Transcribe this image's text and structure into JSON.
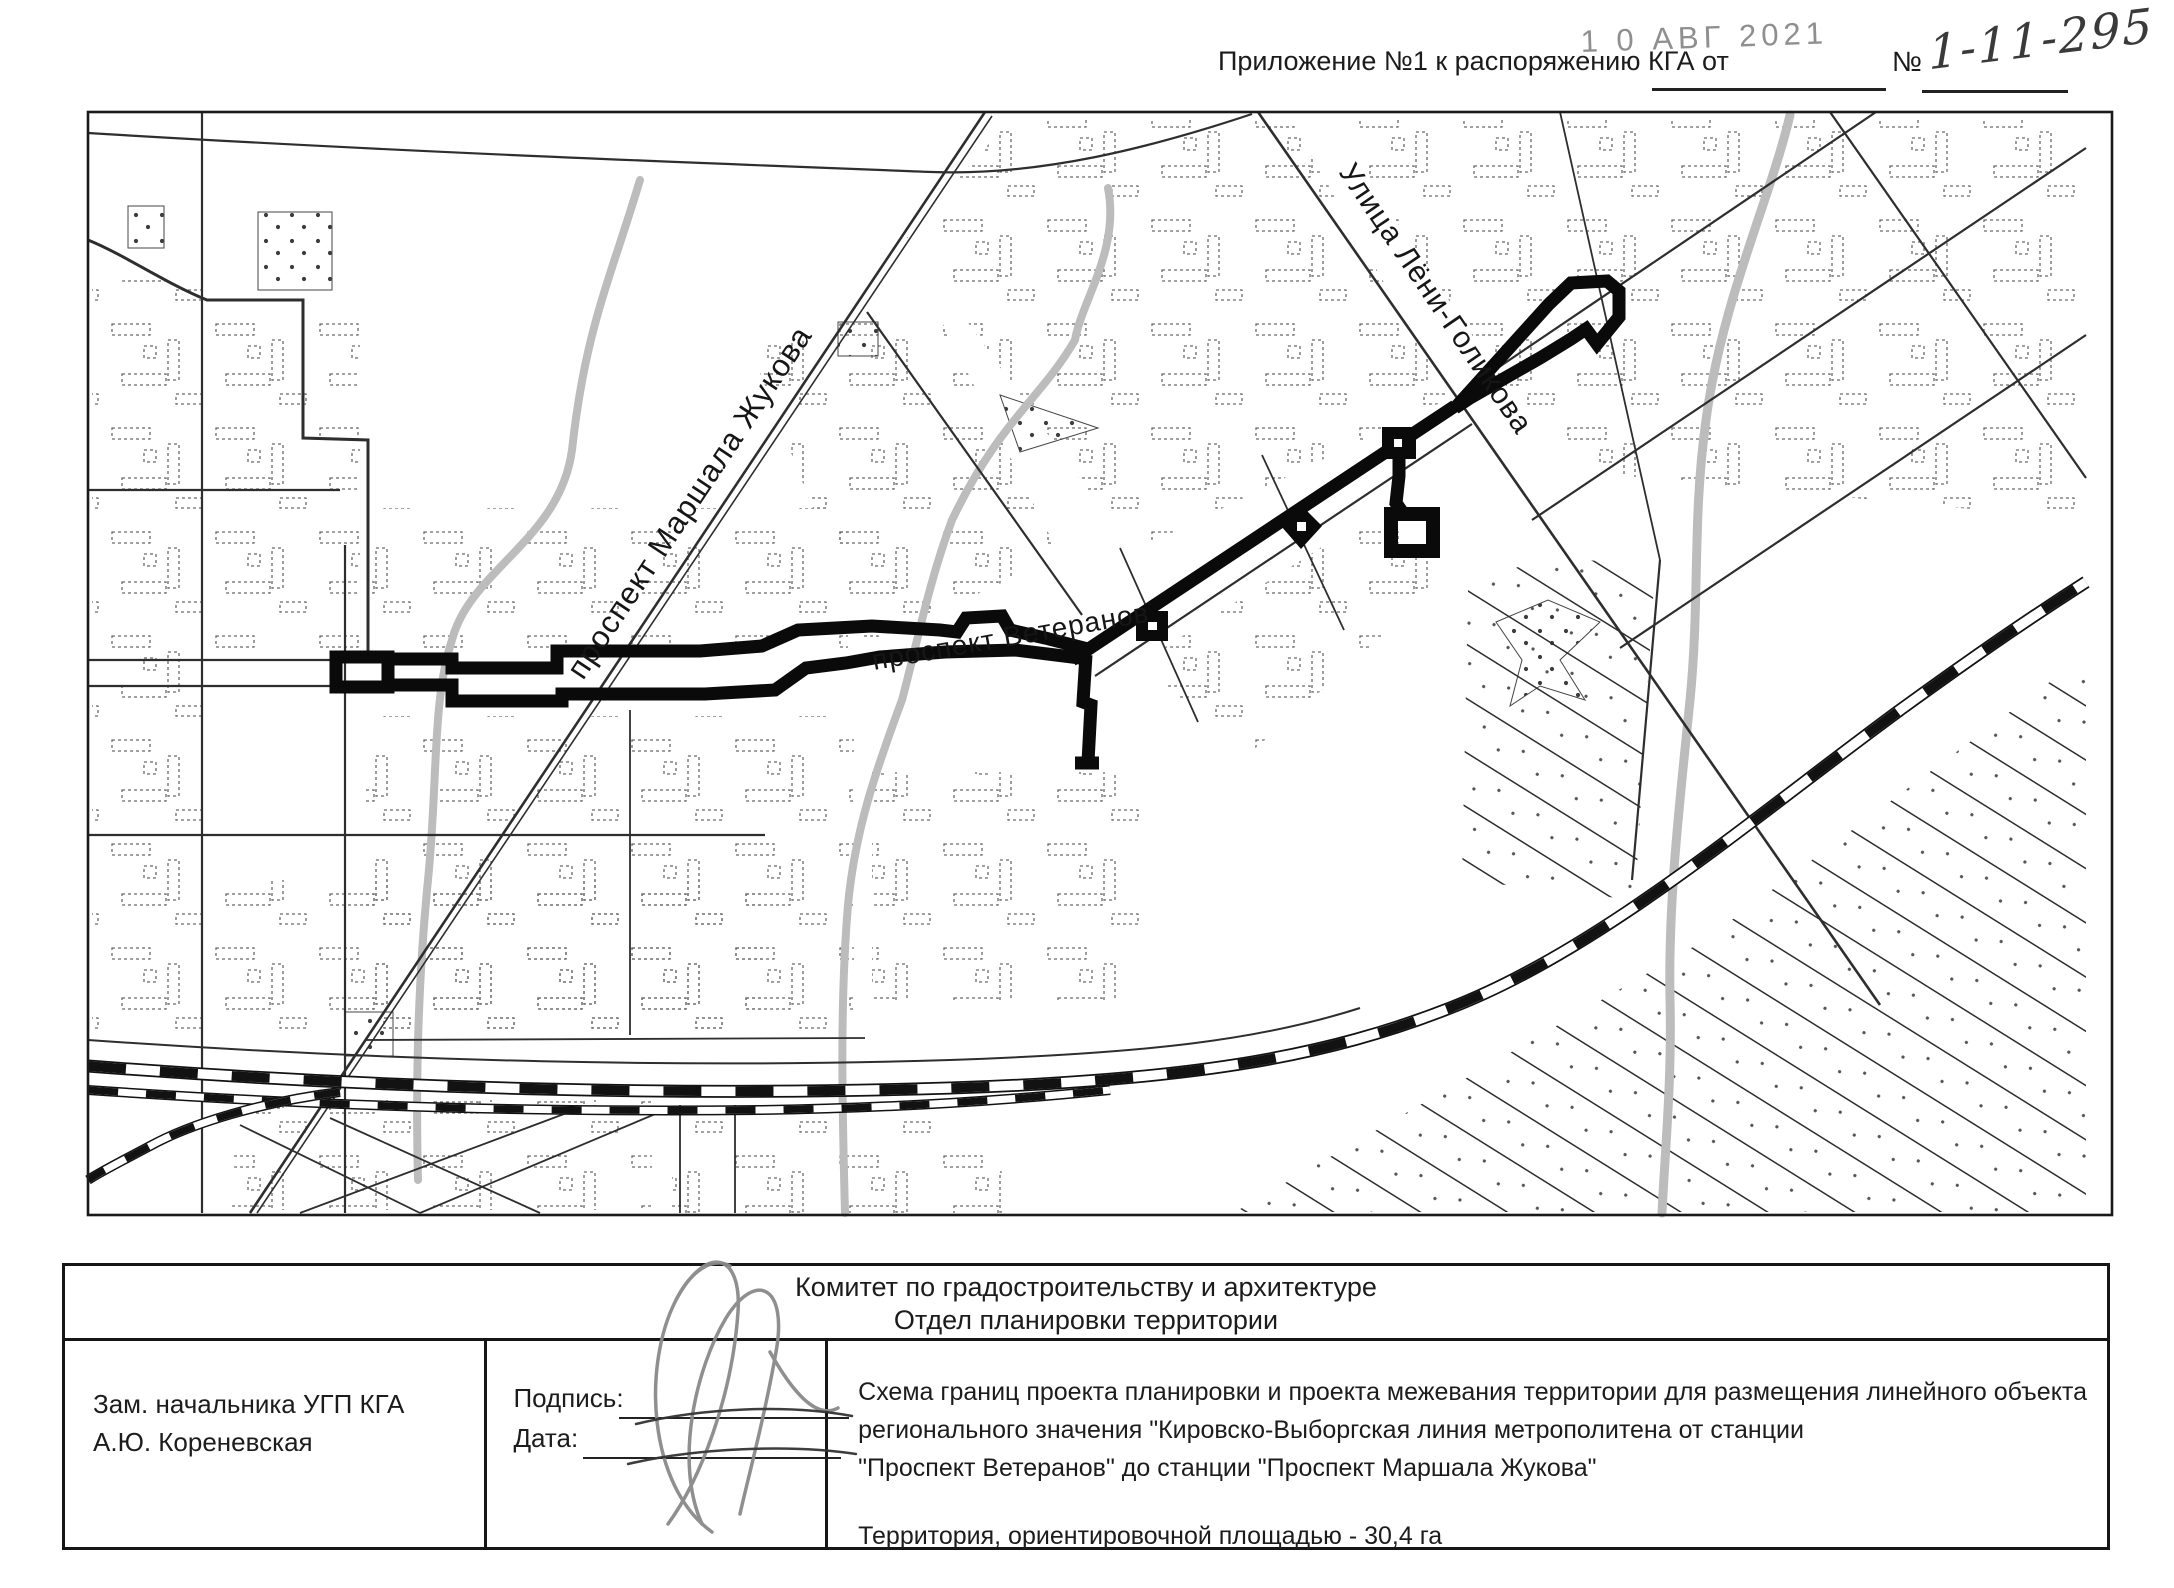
{
  "header": {
    "attachment_label": "Приложение №1 к распоряжению КГА от",
    "stamp_date": "1 0 АВГ 2021",
    "number_sign": "№",
    "number_value": "1-11-295"
  },
  "map": {
    "street_labels": {
      "zhukova": "проспект Маршала Жукова",
      "veteranov": "проспект Ветеранов",
      "golikova": "Улица Лёни-Голикова"
    },
    "colors": {
      "boundary": "#0a0a0a",
      "river": "#bcbcbc",
      "street": "#2e2e2e",
      "paper": "#ffffff"
    }
  },
  "title_block": {
    "org_line1": "Комитет по градостроительству и архитектуре",
    "org_line2": "Отдел планировки территории",
    "official_position": "Зам. начальника УГП КГА",
    "official_name": "А.Ю. Кореневская",
    "signature_label": "Подпись:",
    "date_label": "Дата:",
    "description_lines": [
      "Схема границ проекта планировки и проекта межевания территории для размещения линейного объекта",
      "регионального значения \"Кировско-Выборгская линия метрополитена от станции",
      "\"Проспект Ветеранов\" до станции \"Проспект Маршала Жукова\""
    ],
    "area_line": "Территория, ориентировочной площадью - 30,4 га"
  }
}
